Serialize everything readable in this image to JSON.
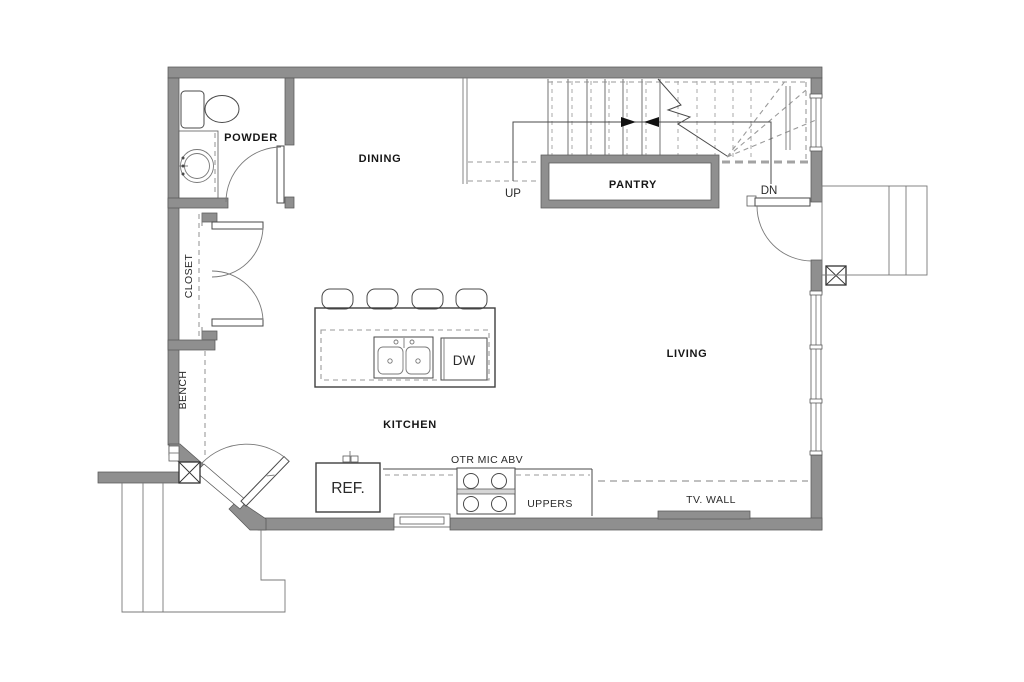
{
  "page": {
    "type": "architectural-floor-plan",
    "level": "main-floor"
  },
  "colors": {
    "wall": "#8f8f8f",
    "wall_edge": "#5a5a5a",
    "fixture_line": "#4a4a4a",
    "dashed_line": "#9a9a9a",
    "text": "#161616",
    "background": "#ffffff"
  },
  "rooms": {
    "powder": "POWDER",
    "dining": "DINING",
    "pantry": "PANTRY",
    "closet": "CLOSET",
    "bench": "BENCH",
    "kitchen": "KITCHEN",
    "living": "LIVING"
  },
  "stairs": {
    "up": "UP",
    "down": "DN"
  },
  "annotations": {
    "refrigerator": "REF.",
    "dishwasher": "DW",
    "otr_microwave": "OTR MIC ABV",
    "uppers": "UPPERS",
    "tv_wall": "TV. WALL"
  },
  "fixtures": {
    "toilet": "toilet",
    "vanity_sink": "round-vanity-sink",
    "island": "kitchen-island",
    "bar_stools": "4-bar-stools",
    "double_sink": "double-basin-sink",
    "range": "4-burner-range",
    "entry_door": "angled-entry-door",
    "living_door": "side-entry-door",
    "closet_doors": "double-closet-doors",
    "porch": "front-porch-steps",
    "deck": "side-landing-steps",
    "posts": "structural-posts"
  }
}
